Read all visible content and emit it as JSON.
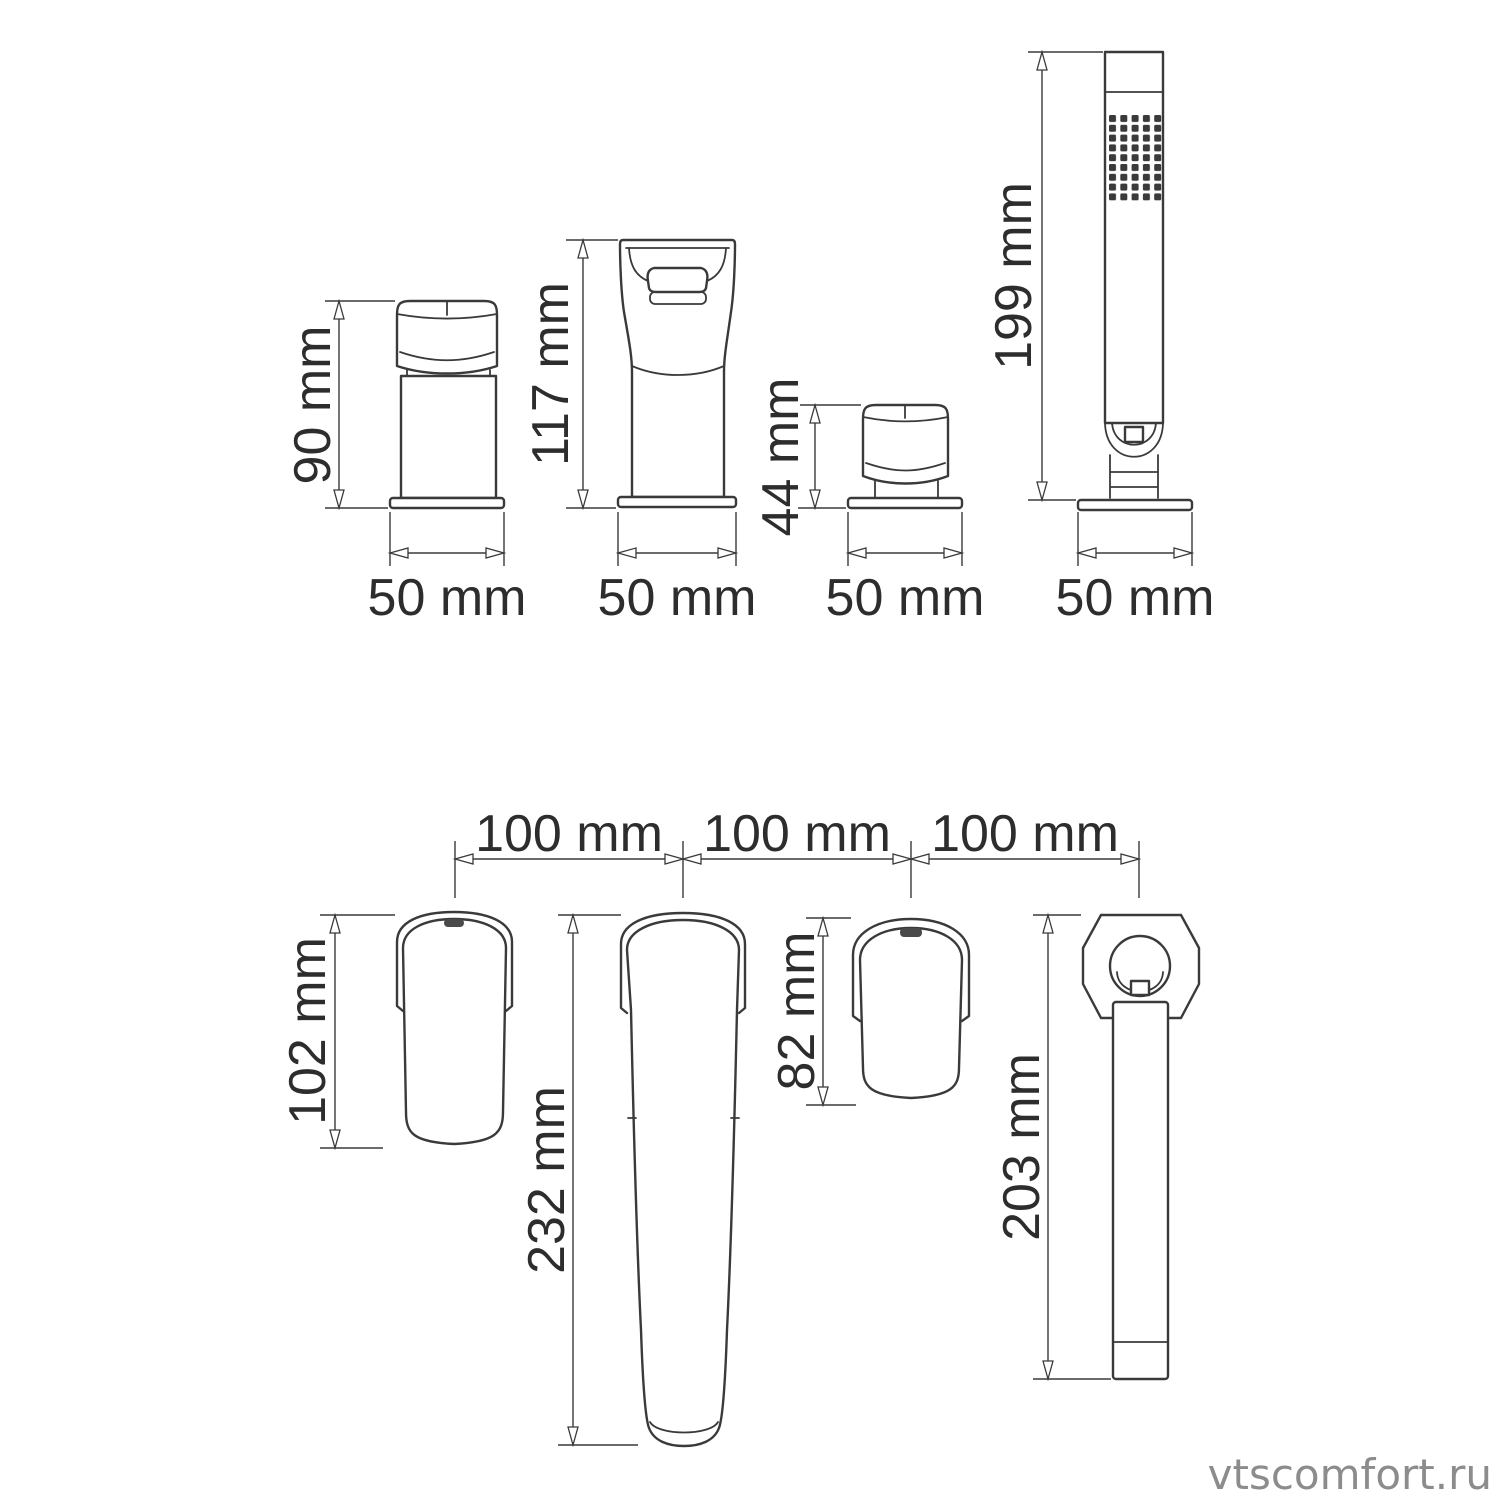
{
  "meta": {
    "background_color": "#ffffff",
    "line_color": "#3a3a3a",
    "detail_fill_color": "#4a4a4a",
    "text_color": "#2d2d2d",
    "watermark_color": "#8c8c8c"
  },
  "watermark": "vtscomfort.ru",
  "front_views": {
    "items": [
      {
        "id": "mixer-handle",
        "height_label": "90 mm",
        "base_width_label": "50 mm"
      },
      {
        "id": "spout",
        "height_label": "117 mm",
        "base_width_label": "50 mm"
      },
      {
        "id": "diverter-handle",
        "height_label": "44 mm",
        "base_width_label": "50 mm"
      },
      {
        "id": "hand-shower",
        "height_label": "199 mm",
        "base_width_label": "50 mm"
      }
    ]
  },
  "top_views": {
    "spacing_labels": [
      "100 mm",
      "100 mm",
      "100 mm"
    ],
    "items": [
      {
        "id": "mixer-handle",
        "length_label": "102 mm"
      },
      {
        "id": "spout",
        "length_label": "232 mm"
      },
      {
        "id": "diverter-handle",
        "length_label": "82 mm"
      },
      {
        "id": "hand-shower",
        "length_label": "203 mm"
      }
    ]
  }
}
